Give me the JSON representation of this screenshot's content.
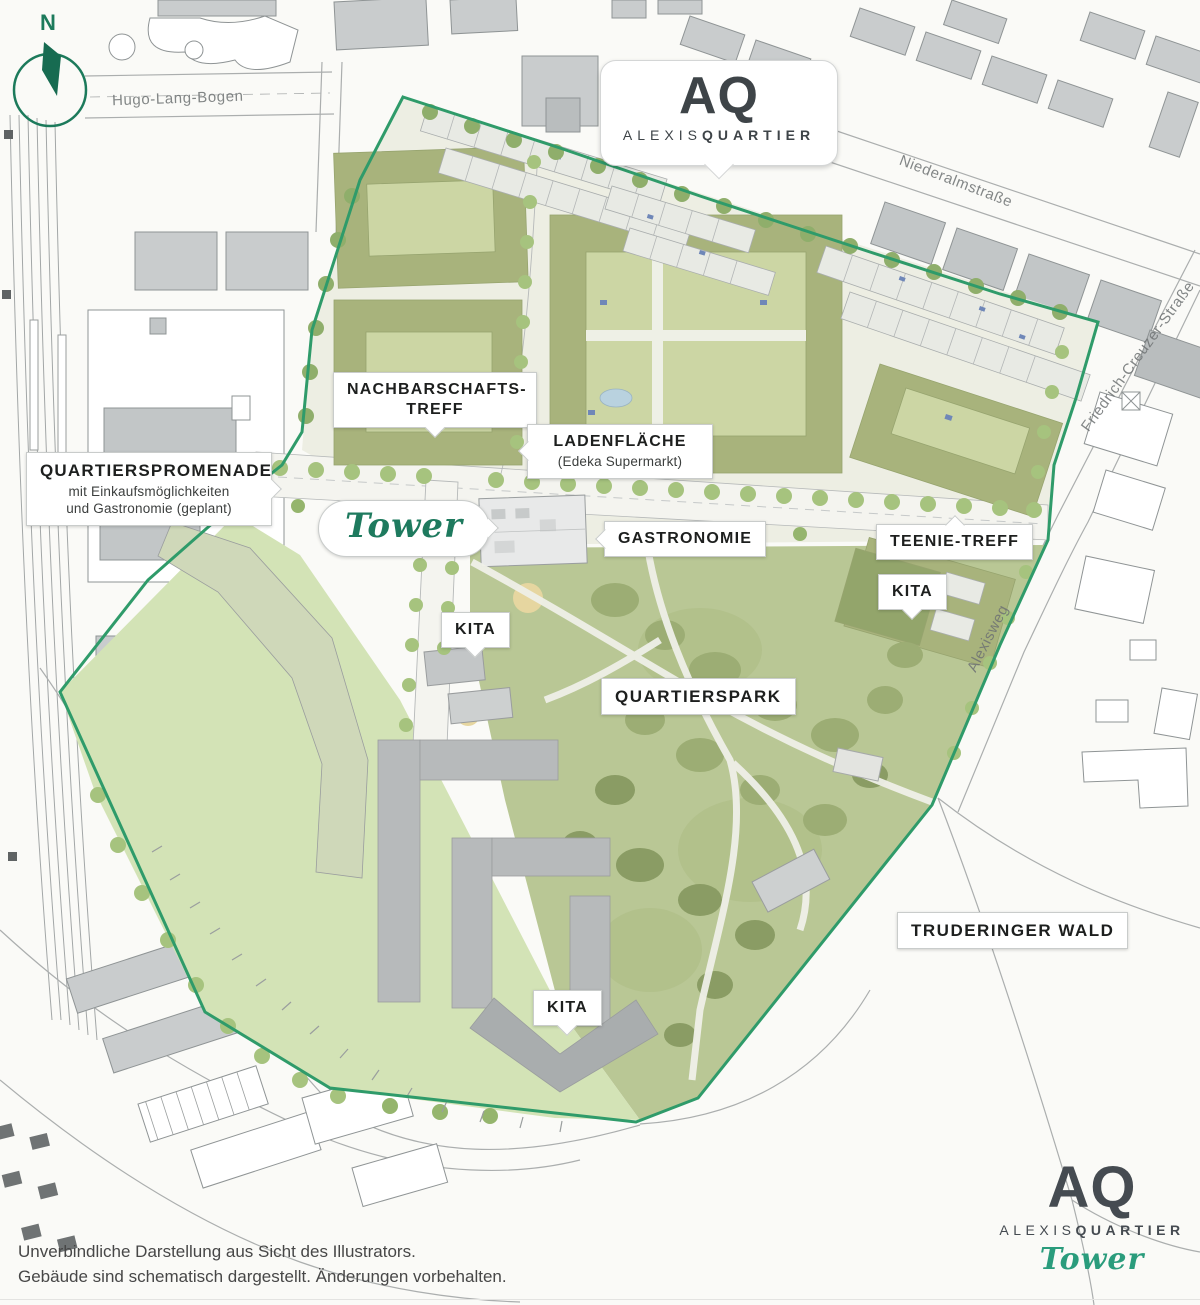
{
  "page": {
    "type": "site-plan",
    "project": "ALEXISQUARTIER Tower"
  },
  "compass": {
    "label": "N"
  },
  "brand_top": {
    "monogram": "AQ",
    "name_light": "ALEXIS",
    "name_bold": "QUARTIER"
  },
  "brand_bottom": {
    "monogram": "AQ",
    "name_light": "ALEXIS",
    "name_bold": "QUARTIER",
    "product": "Tower"
  },
  "streets": {
    "hugo": "Hugo-Lang-Bogen",
    "niederalm": "Niederalmstraße",
    "friedrich": "Friedrich-Creuzer-Straße",
    "alexisweg": "Alexisweg"
  },
  "callouts": {
    "promenade": {
      "title": "QUARTIERSPROMENADE",
      "line2": "mit Einkaufsmöglichkeiten",
      "line3": "und Gastronomie (geplant)"
    },
    "nachbarschaftstreff": {
      "title": "NACHBARSCHAFTS-TREFF"
    },
    "ladenflaeche": {
      "title": "LADENFLÄCHE",
      "sub": "(Edeka Supermarkt)"
    },
    "tower": {
      "title": "Tower"
    },
    "gastronomie": {
      "title": "GASTRONOMIE"
    },
    "teenietreff": {
      "title": "TEENIE-TREFF"
    },
    "kita_right": {
      "title": "KITA"
    },
    "kita_center": {
      "title": "KITA"
    },
    "quartierspark": {
      "title": "QUARTIERSPARK"
    },
    "kita_south": {
      "title": "KITA"
    },
    "truderinger_wald": {
      "title": "TRUDERINGER WALD"
    }
  },
  "footer": {
    "line1": "Unverbindliche Darstellung aus Sicht des Illustrators.",
    "line2": "Gebäude sind schematisch dargestellt. Änderungen vorbehalten."
  },
  "colors": {
    "brand_green": "#1e7a5e",
    "boundary_green": "#2f9b6a",
    "logo_gray": "#3e4448",
    "script_green": "#2a9c7c",
    "park_green": "#b9c795",
    "field_green": "#d3e3b6",
    "roof_olive": "#a8b37c"
  }
}
